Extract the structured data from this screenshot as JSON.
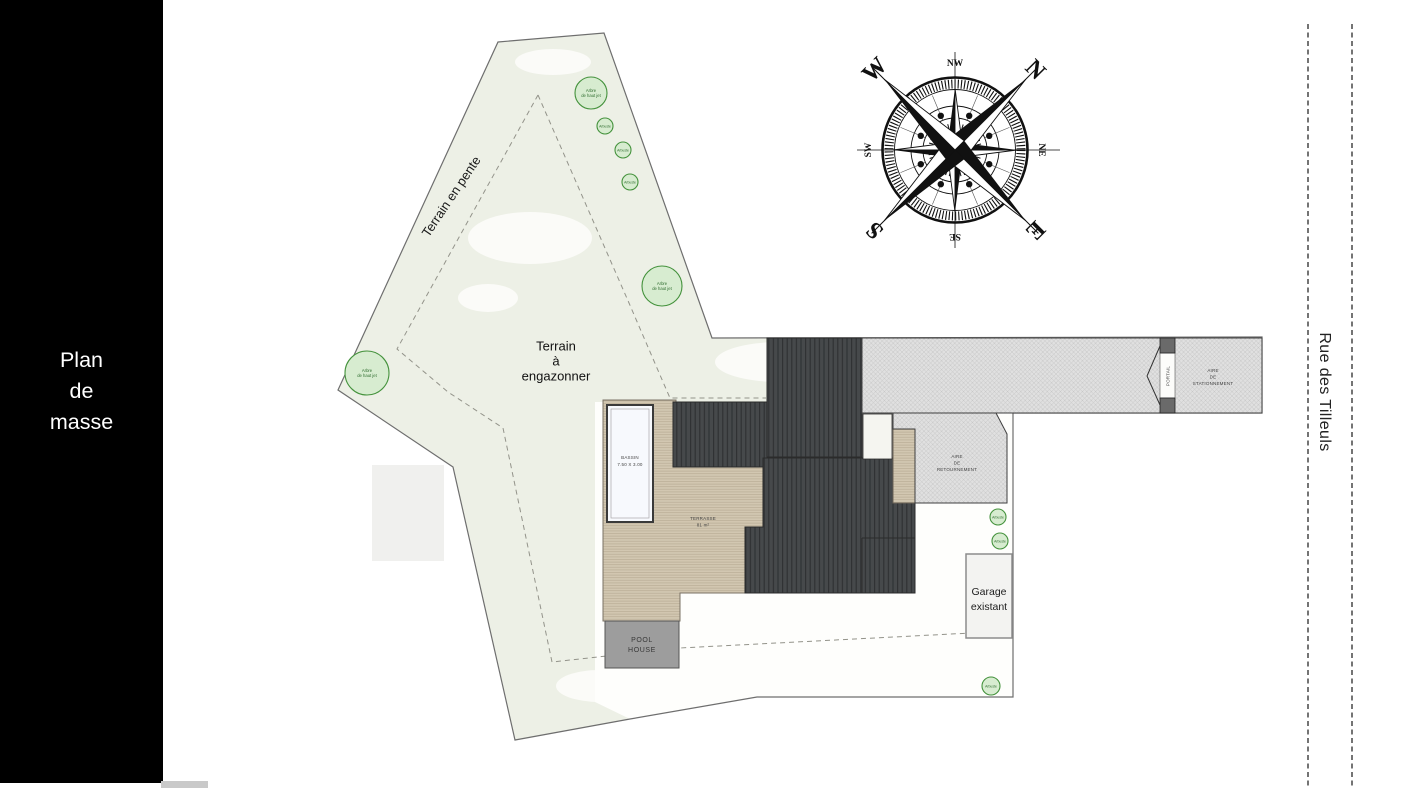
{
  "colors": {
    "sidebar_bg": "#000000",
    "terrain_green": "#edf0e6",
    "roof_dark": "#46494b",
    "terrace_tan": "#d2c7b1",
    "gravel_gray": "#e0e0e0",
    "pool_fill": "#f7f9fd",
    "pool_house_gray": "#9d9d9d",
    "tree_green": "#d7ecd0",
    "tree_stroke": "#44923c"
  },
  "sidebar": {
    "title_lines": [
      "Plan",
      "de",
      "masse"
    ]
  },
  "street": {
    "name": "Rue des Tilleuls"
  },
  "compass": {
    "n": "N",
    "e": "E",
    "s": "S",
    "w": "W",
    "nw": "NW",
    "ne": "NE",
    "se": "SE",
    "sw": "SW"
  },
  "site": {
    "terrain_slope": "Terrain en pente",
    "lawn": [
      "Terrain",
      "à",
      "engazonner"
    ],
    "pool": [
      "BASSIN",
      "7.50 X 3.00"
    ],
    "terrace": [
      "TERRASSE",
      "81 m²"
    ],
    "pool_house": [
      "POOL",
      "HOUSE"
    ],
    "garage": [
      "Garage",
      "existant"
    ],
    "turning": [
      "AIRE",
      "DE",
      "RETOURNEMENT"
    ],
    "parking": [
      "AIRE",
      "DE",
      "STATIONNEMENT"
    ],
    "gate": "PORTAIL",
    "tree": [
      "Arbre",
      "de haut jet"
    ],
    "shrub": "Arbuste"
  }
}
